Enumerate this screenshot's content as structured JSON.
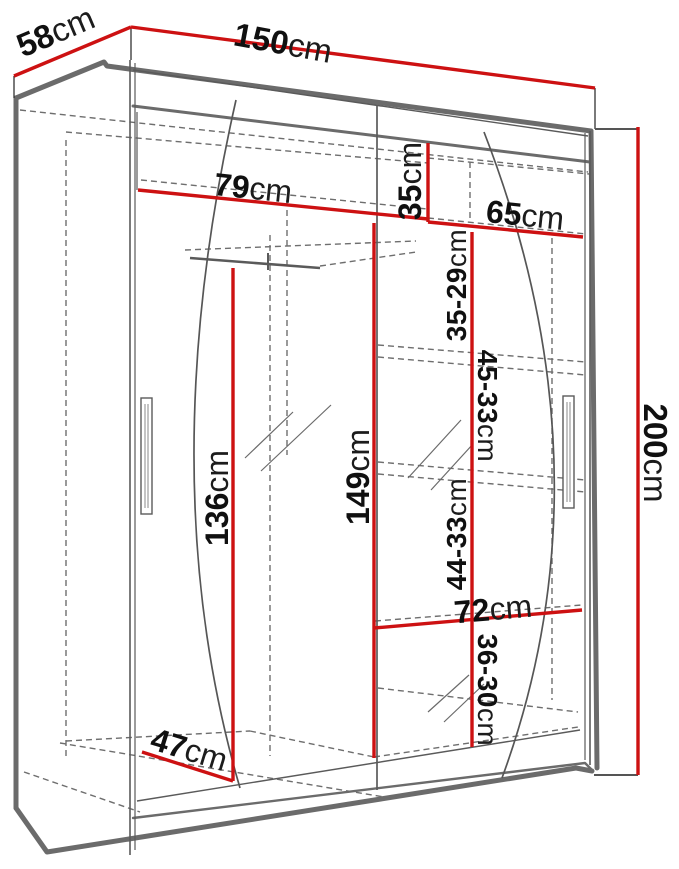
{
  "diagram": {
    "subject": "wardrobe-dimension-diagram",
    "colors": {
      "dimension_line": "#cd1112",
      "cabinet_outline": "#6b6b6b",
      "thin_line": "#5a5a5a",
      "dashed_line": "#6e6e6e",
      "label_text": "#101010",
      "background": "#ffffff"
    },
    "dims": {
      "d58": {
        "value": "58",
        "unit": "cm"
      },
      "d150": {
        "value": "150",
        "unit": "cm"
      },
      "d200": {
        "value": "200",
        "unit": "cm"
      },
      "d79": {
        "value": "79",
        "unit": "cm"
      },
      "d35": {
        "value": "35",
        "unit": "cm"
      },
      "d65": {
        "value": "65",
        "unit": "cm"
      },
      "r35_29": {
        "value": "35-29",
        "unit": "cm"
      },
      "r45_33": {
        "value": "45-33",
        "unit": "cm"
      },
      "r44_33": {
        "value": "44-33",
        "unit": "cm"
      },
      "r36_30": {
        "value": "36-30",
        "unit": "cm"
      },
      "d136": {
        "value": "136",
        "unit": "cm"
      },
      "d149": {
        "value": "149",
        "unit": "cm"
      },
      "d72": {
        "value": "72",
        "unit": "cm"
      },
      "d47": {
        "value": "47",
        "unit": "cm"
      }
    }
  }
}
